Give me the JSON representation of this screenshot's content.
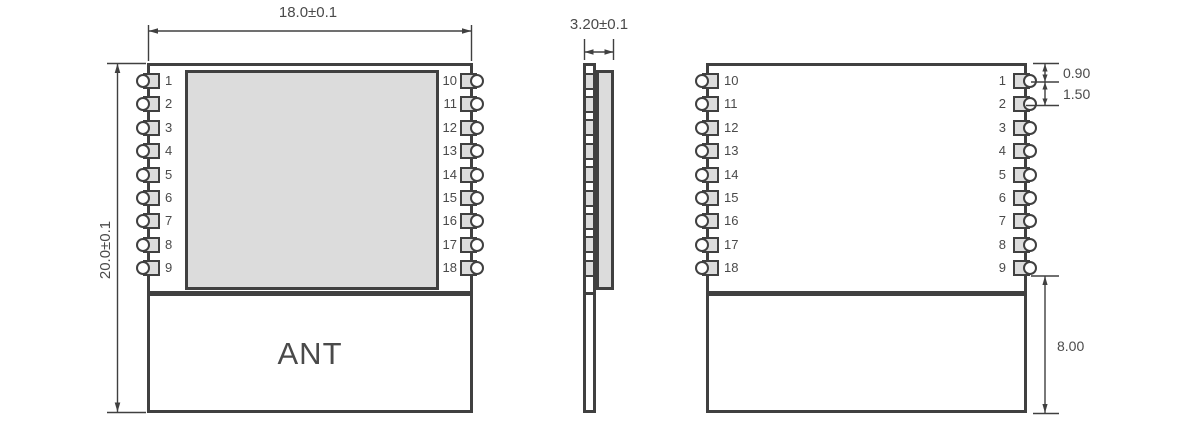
{
  "dimensions": {
    "front_width": "18.0±0.1",
    "front_height": "20.0±0.1",
    "side_thickness": "3.20±0.1",
    "pin_top_offset": "0.90",
    "pin_pitch": "1.50",
    "antenna_section_height": "8.00"
  },
  "front_view": {
    "left_pins": [
      "1",
      "2",
      "3",
      "4",
      "5",
      "6",
      "7",
      "8",
      "9"
    ],
    "right_pins": [
      "10",
      "11",
      "12",
      "13",
      "14",
      "15",
      "16",
      "17",
      "18"
    ],
    "antenna_label": "ANT"
  },
  "back_view": {
    "left_pins": [
      "10",
      "11",
      "12",
      "13",
      "14",
      "15",
      "16",
      "17",
      "18"
    ],
    "right_pins": [
      "1",
      "2",
      "3",
      "4",
      "5",
      "6",
      "7",
      "8",
      "9"
    ]
  },
  "colors": {
    "line": "#404040",
    "pad_fill": "#dcdcdc",
    "text": "#4a4a4a",
    "background": "#ffffff"
  }
}
